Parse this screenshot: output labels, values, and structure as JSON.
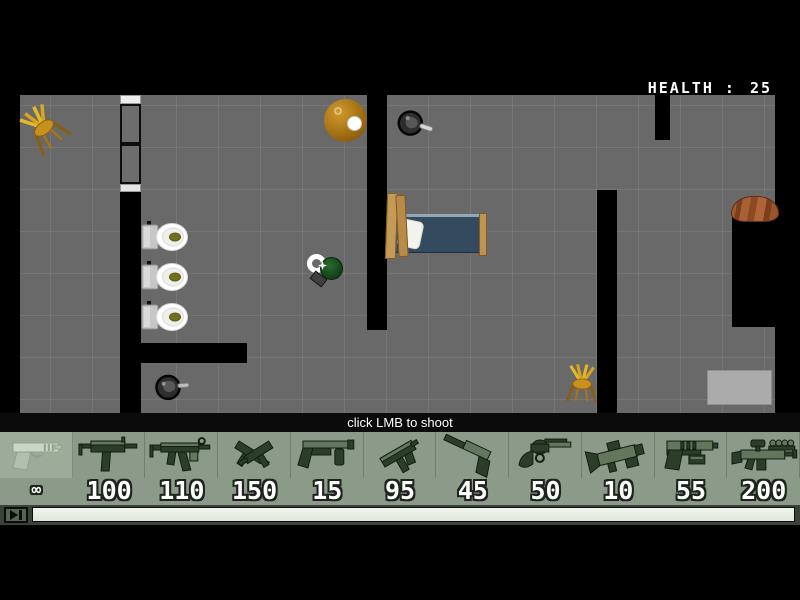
{
  "hud": {
    "health_label": "HEALTH :",
    "health_value": "25"
  },
  "hint": {
    "text": "click LMB to shoot"
  },
  "weapons": {
    "slots": [
      {
        "name": "desert-eagle",
        "ammo": "∞",
        "selected": true
      },
      {
        "name": "uzi",
        "ammo": "100",
        "selected": false
      },
      {
        "name": "mp5",
        "ammo": "110",
        "selected": false
      },
      {
        "name": "dual-uzis",
        "ammo": "150",
        "selected": false
      },
      {
        "name": "shotgun",
        "ammo": "15",
        "selected": false
      },
      {
        "name": "machine-pistol",
        "ammo": "95",
        "selected": false
      },
      {
        "name": "silenced-pistol",
        "ammo": "45",
        "selected": false
      },
      {
        "name": "revolver",
        "ammo": "50",
        "selected": false
      },
      {
        "name": "grenade-launcher",
        "ammo": "10",
        "selected": false
      },
      {
        "name": "laser-pistol",
        "ammo": "55",
        "selected": false
      },
      {
        "name": "scoped-rifle",
        "ammo": "200",
        "selected": false
      }
    ]
  },
  "transport": {
    "play_icon": "▶|"
  },
  "colors": {
    "bar_bg": "#8c9a8a",
    "floor": "#696969",
    "wall": "#000000",
    "health_text": "#ffffff",
    "mattress": "#344a5e",
    "wood": "#c49a57",
    "toilet_water": "#72701c",
    "chair_gold": "#d9a41f"
  }
}
